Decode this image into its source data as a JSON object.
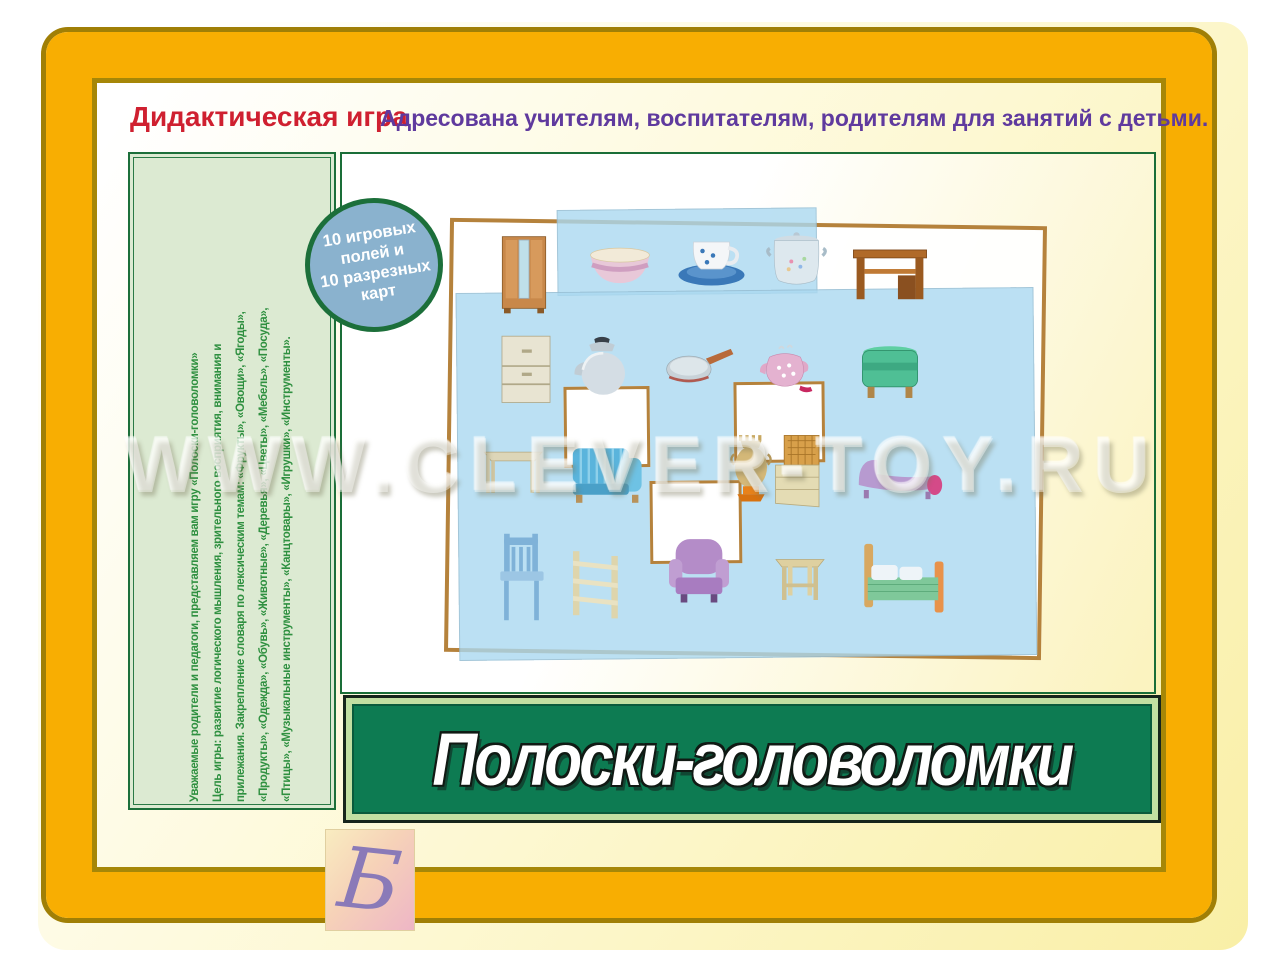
{
  "header": {
    "label": "Дидактическая игра",
    "audience": "Адресована учителям, воспитателям, родителям для занятий с детьми."
  },
  "sidebar": {
    "lines": [
      "Уважаемые родители и педагоги, представляем вам игру «Полоски-головоломки»",
      "Цель игры: развитие логического мышления, зрительного восприятия, внимания и",
      "прилежания. Закрепление словаря по лексическим темам: «Фрукты», «Овощи», «Ягоды»,",
      "«Продукты», «Одежда», «Обувь», «Животные», «Деревья», «Цветы», «Мебель», «Посуда»,",
      "«Птицы», «Музыкальные инструменты», «Канцтовары», «Игрушки», «Инструменты»."
    ]
  },
  "logo": {
    "glyph": "Б"
  },
  "badge": {
    "line1": "10 игровых полей и",
    "line2": "10 разрезных карт"
  },
  "banner": {
    "title": "Полоски-головоломки"
  },
  "watermark": {
    "text": "WWW.CLEVER-TOY.RU"
  },
  "board": {
    "furniture_items": [
      "wardrobe",
      "chest-of-drawers",
      "table",
      "chair",
      "desk",
      "pouf",
      "chaise-longue",
      "bed",
      "sofa",
      "shelf",
      "armchair",
      "stool",
      "wicker-cabinet",
      "samovar"
    ],
    "dish_items": [
      "bowl",
      "cup-and-saucer",
      "pot",
      "kettle",
      "frying-pan",
      "teapot"
    ],
    "empty_slots": 3
  },
  "colors": {
    "frame_gold": "#f8ae02",
    "frame_gold_dark": "#a68708",
    "banner_green": "#0d7b52",
    "banner_light_border": "#c2dfa2",
    "sidebar_green": "#dcead2",
    "border_green": "#1c6f3a",
    "badge_blue": "#8ab2ce",
    "title_red": "#cf2030",
    "subtitle_purple": "#5f3a9e",
    "dishes_card_blue": "#aad8f0",
    "card_border_brown": "#b5823c"
  }
}
